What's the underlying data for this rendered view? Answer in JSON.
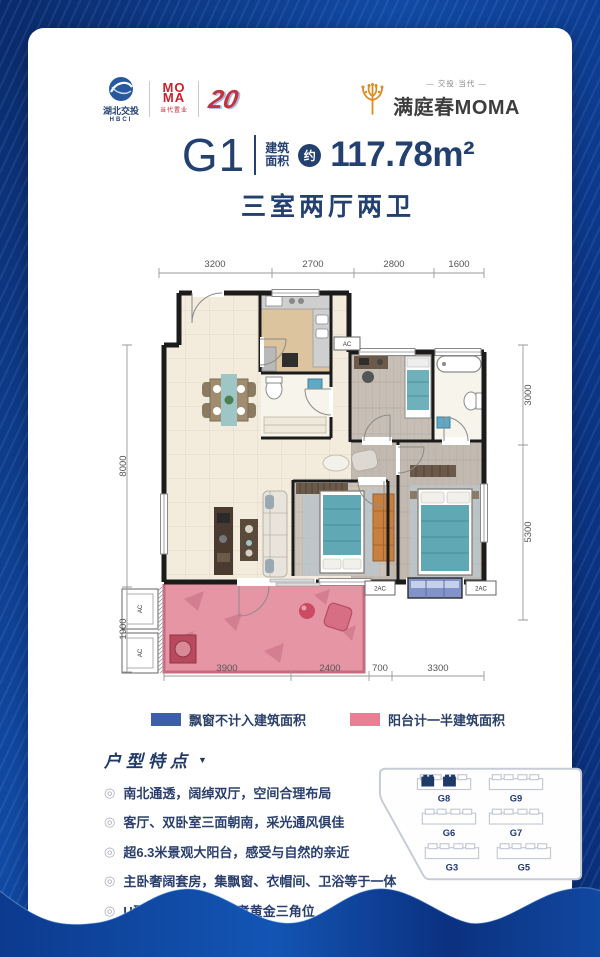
{
  "header": {
    "hbci": {
      "name": "湖北交投",
      "sub": "HBCI"
    },
    "moma": {
      "line1": "MO",
      "line2": "MA",
      "sub": "当代置业"
    },
    "badge": "20",
    "brand": {
      "top": "— 交投·当代 —",
      "name": "满庭春MOMA"
    }
  },
  "title": {
    "unit": "G1",
    "label1": "建筑",
    "label2": "面积",
    "approx": "约",
    "area": "117.78m²",
    "subtitle": "三室两厅两卫"
  },
  "floorplan": {
    "dims_top": [
      "3200",
      "2700",
      "2800",
      "1600"
    ],
    "dims_bottom": [
      "3900",
      "2400",
      "700",
      "3300"
    ],
    "dims_left": [
      "8000",
      "1900"
    ],
    "dims_right": [
      "3000",
      "5300"
    ],
    "ac_top": "AC",
    "ac_left1": "AC",
    "ac_left2": "AC",
    "ac_b1": "2AC",
    "ac_b2": "2AC"
  },
  "legend": {
    "items": [
      {
        "label": "飘窗不计入建筑面积",
        "color": "#3d5fa9"
      },
      {
        "label": "阳台计一半建筑面积",
        "color": "#e87f92"
      }
    ]
  },
  "features": {
    "title": "户型特点",
    "marker": "▼",
    "bullets": [
      "南北通透，阔绰双厅，空间合理布局",
      "客厅、双卧室三面朝南，采光通风俱佳",
      "超6.3米景观大阳台，感受与自然的亲近",
      "主卧奢阔套房，集飘窗、衣帽间、卫浴等于一体",
      "U型厨房，洗、切、煮黄金三角位"
    ],
    "disclaimer": "*本计划书中的房屋面积以最终产权测量面积为准"
  },
  "siteplan": {
    "labels": [
      "G8",
      "G9",
      "G6",
      "G7",
      "G3",
      "G5"
    ],
    "highlight_color": "#1e3a66"
  }
}
